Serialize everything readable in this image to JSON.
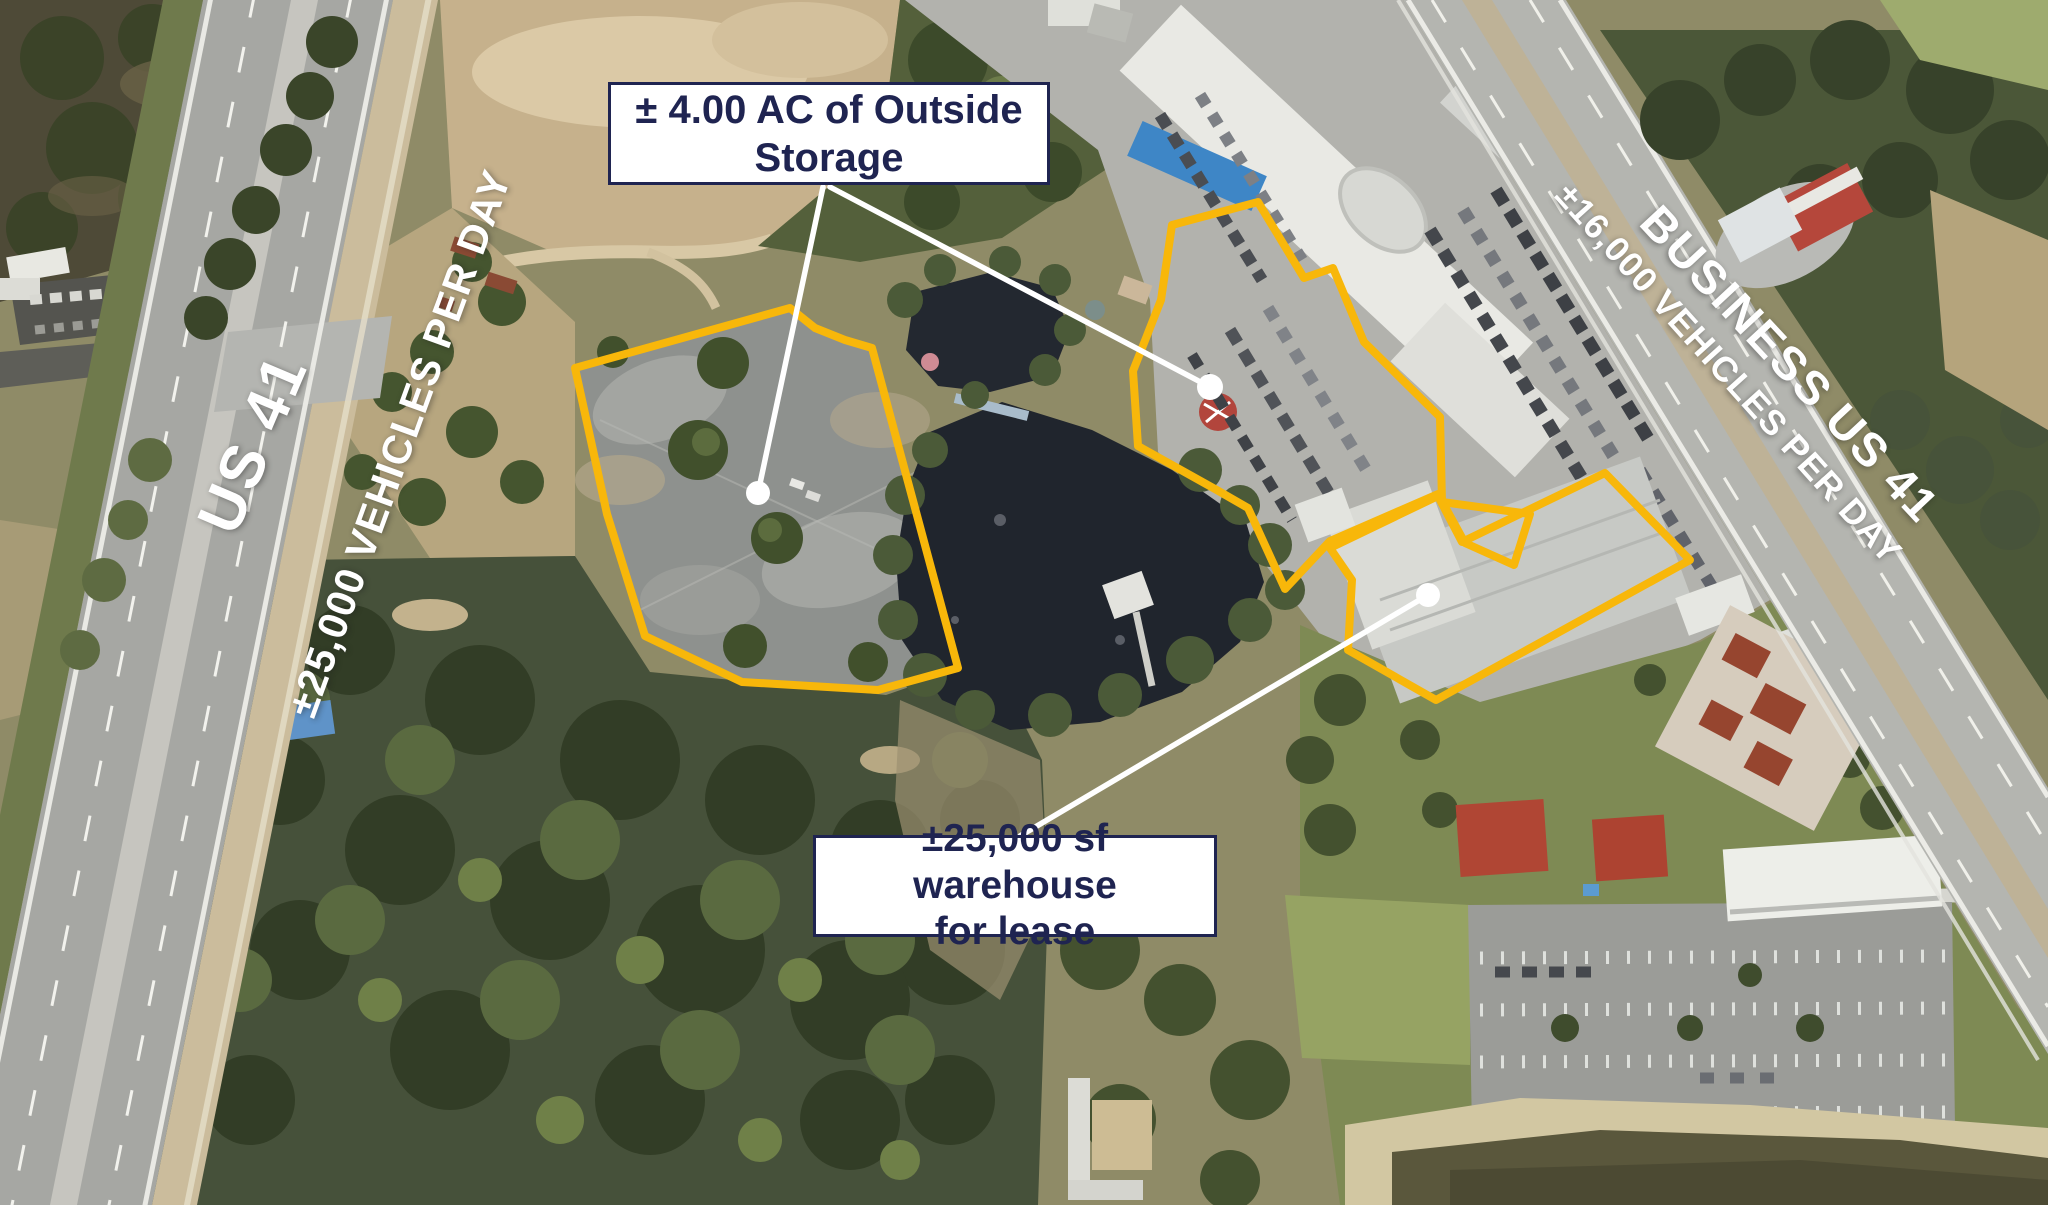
{
  "roads": {
    "us41": {
      "label": "US 41",
      "traffic_count": "±25,000 VEHICLES PER DAY"
    },
    "business_us41": {
      "label": "BUSINESS US 41",
      "traffic_count": "±16,000 VEHICLES PER DAY"
    }
  },
  "callouts": {
    "outside_storage": {
      "line1": "± 4.00 AC of Outside",
      "line2": "Storage"
    },
    "warehouse_lease": {
      "line1": "±25,000 sf warehouse",
      "line2": "for lease"
    }
  },
  "colors": {
    "parcel_outline": "#F8B70A",
    "leader_line": "#FFFFFF",
    "callout_border": "#1F2451",
    "callout_text": "#1F2451",
    "callout_background": "#FFFFFF",
    "road_label_text": "#FFFFFF"
  }
}
